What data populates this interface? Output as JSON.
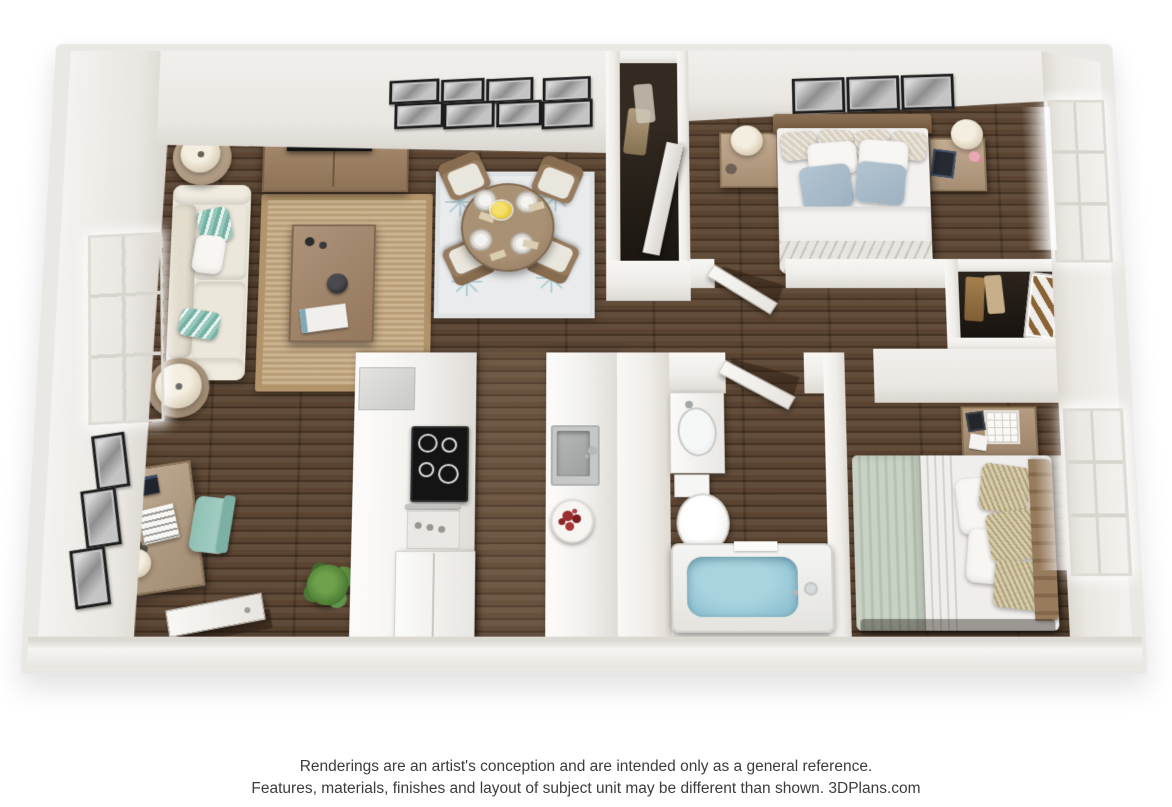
{
  "footer": {
    "line1": "Renderings are an artist's conception and are intended only as a general reference.",
    "line2": "Features, materials, finishes and layout of subject unit may be different than shown. 3DPlans.com"
  },
  "scene": {
    "type": "3d-floor-plan-rendering",
    "view": "top-down dollhouse perspective",
    "rooms": [
      {
        "name": "living-room",
        "items": [
          "sofa-with-teal-pillows",
          "jute-area-rug",
          "coffee-table",
          "tv-console",
          "television",
          "gallery-wall-8-frames",
          "round-side-table-lamp",
          "floor-lamp",
          "window"
        ]
      },
      {
        "name": "dining-area",
        "items": [
          "round-dining-table",
          "four-dining-chairs",
          "four-place-settings",
          "yellow-flower-centerpiece",
          "starburst-pattern-rug"
        ]
      },
      {
        "name": "office-nook",
        "items": [
          "desk",
          "teal-office-chair",
          "desk-lamp",
          "alarm-clock",
          "notebook",
          "three-wall-frames",
          "potted-plant",
          "open-entry-door"
        ]
      },
      {
        "name": "kitchen",
        "items": [
          "cooktop",
          "oven",
          "refrigerator",
          "dishwasher",
          "sink",
          "fruit-bowl",
          "white-cabinets"
        ]
      },
      {
        "name": "bathroom",
        "items": [
          "vanity-sink",
          "toilet",
          "bathtub-with-water",
          "open-door"
        ]
      },
      {
        "name": "bedroom-1",
        "items": [
          "double-bed-blue-pillows",
          "two-nightstands",
          "two-table-lamps",
          "three-wall-frames",
          "window",
          "reach-in-closet"
        ]
      },
      {
        "name": "bedroom-2",
        "items": [
          "double-bed-sage-blanket",
          "desk-nightstand",
          "lattice-cube",
          "window",
          "closet-with-mirror"
        ]
      },
      {
        "name": "hallway",
        "items": [
          "linen-closet",
          "bedroom-door",
          "bathroom-door"
        ]
      }
    ],
    "colors": {
      "wood_floor": "#5a4330",
      "walls": "#efedea",
      "sofa_cream": "#eae5d9",
      "accent_teal": "#8fc0b8",
      "rug_jute": "#c4a87f",
      "rug_dining": "#e9ebec",
      "blue_pillow": "#a6bac9",
      "sage_blanket": "#c3cdbf",
      "tub_water": "#8fc0d4",
      "frame_black": "#1f1f1f",
      "flower_yellow": "#e8c937",
      "fruit_red": "#992e2e",
      "disclaimer_text": "#3c3c3c"
    }
  }
}
